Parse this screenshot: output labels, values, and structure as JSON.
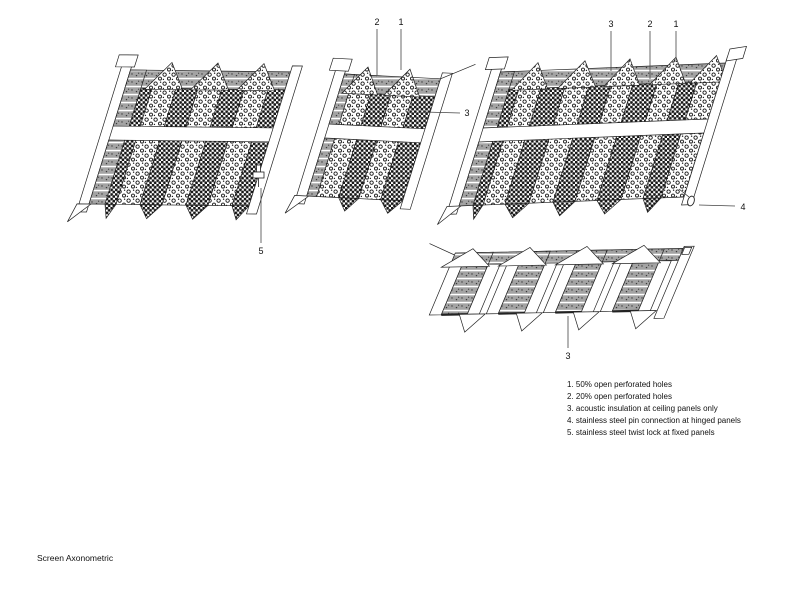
{
  "title": {
    "text": "Screen Axonometric"
  },
  "legend": {
    "items": [
      "1. 50% open perforated holes",
      "2. 20% open perforated holes",
      "3. acoustic insulation at ceiling panels only",
      "4. stainless steel pin connection at hinged panels",
      "5. stainless steel twist lock at fixed panels"
    ]
  },
  "colors": {
    "line": "#222222",
    "insulation_gray": "#a3a3a3",
    "background": "#ffffff"
  },
  "drawing": {
    "panels": [
      {
        "id": "left-screen",
        "o": [
          133,
          62
        ],
        "W": 160,
        "ty": 0.012,
        "lean": -0.31,
        "rows": 2,
        "rowH": 64,
        "pitch": 78,
        "tipH": 14,
        "bandTop": 8,
        "bandBot": 26,
        "peakBase": 27,
        "stripes": [
          [
            "insul",
            16
          ],
          [
            "dark",
            11
          ],
          [
            "pebble",
            24
          ],
          [
            "dark",
            22
          ],
          [
            "pebble",
            24
          ],
          [
            "dark",
            22
          ],
          [
            "pebble",
            24
          ],
          [
            "dark",
            17
          ]
        ],
        "features": [
          "leftRail",
          "topLeftBox",
          "bottomLeftFlag",
          "rightRail"
        ]
      },
      {
        "id": "middle-screen",
        "o": [
          347,
          66
        ],
        "W": 96,
        "ty": 0.05,
        "lean": -0.31,
        "rows": 2,
        "rowH": 58,
        "pitch": 72,
        "tipH": 13,
        "bandTop": 8,
        "bandBot": 26,
        "peakBase": 27,
        "stripes": [
          [
            "insul",
            10
          ],
          [
            "pebble",
            22
          ],
          [
            "dark",
            20
          ],
          [
            "pebble",
            22
          ],
          [
            "dark",
            22
          ]
        ],
        "features": [
          "leftRail",
          "topLeftBox",
          "bottomLeftFlag",
          "rightRail",
          "topRightLine"
        ]
      },
      {
        "id": "right-screen",
        "o": [
          503,
          64
        ],
        "W": 225,
        "ty": -0.04,
        "lean": -0.31,
        "rows": 2,
        "rowH": 64,
        "pitch": 78,
        "tipH": 14,
        "bandTop": 8,
        "bandBot": 26,
        "peakBase": 27,
        "stripes": [
          [
            "insul",
            14
          ],
          [
            "dark",
            10
          ],
          [
            "pebble",
            22
          ],
          [
            "dark",
            24
          ],
          [
            "pebble",
            24
          ],
          [
            "dark",
            22
          ],
          [
            "pebble",
            22
          ],
          [
            "dark",
            24
          ],
          [
            "pebble",
            22
          ],
          [
            "dark",
            18
          ],
          [
            "pebble",
            23
          ]
        ],
        "features": [
          "leftRail",
          "topLeftBox",
          "bottomLeftFlag",
          "rightRail",
          "topRightBox"
        ]
      },
      {
        "id": "ceiling-screen",
        "o": [
          457,
          249
        ],
        "W": 228,
        "ty": -0.02,
        "lean": -0.42,
        "rows": 1,
        "rowH": 66,
        "pitch": 80,
        "tipH": 18,
        "bandTop": 4,
        "bandBot": 16,
        "peakBase": 18,
        "stripes": [
          [
            "plain",
            12
          ],
          [
            "insul",
            26
          ],
          [
            "plain",
            12
          ],
          [
            "spacer",
            7
          ],
          [
            "plain",
            12
          ],
          [
            "insul",
            26
          ],
          [
            "plain",
            12
          ],
          [
            "spacer",
            7
          ],
          [
            "plain",
            12
          ],
          [
            "insul",
            26
          ],
          [
            "plain",
            12
          ],
          [
            "spacer",
            7
          ],
          [
            "plain",
            12
          ],
          [
            "insul",
            26
          ],
          [
            "plain",
            12
          ],
          [
            "spacer",
            7
          ]
        ],
        "peaks": [
          16,
          73,
          130,
          187
        ],
        "peakHW": 24,
        "peakFill": "#ffffff",
        "tips": [
          [
            30,
            56
          ],
          [
            87,
            113
          ],
          [
            144,
            170
          ],
          [
            201,
            227
          ]
        ],
        "tipFill": "#ffffff",
        "thickBottom": true,
        "features": [
          "rightRail",
          "topRightBoxSmall",
          "leftTailLine"
        ]
      }
    ],
    "callouts": [
      {
        "label": "2",
        "x": 377,
        "y": 22,
        "line": [
          377,
          29,
          377,
          75
        ]
      },
      {
        "label": "1",
        "x": 401,
        "y": 22,
        "line": [
          401,
          29,
          401,
          70
        ]
      },
      {
        "label": "3",
        "x": 467,
        "y": 113,
        "line": [
          460,
          113,
          424,
          112
        ]
      },
      {
        "label": "3",
        "x": 611,
        "y": 24,
        "line": [
          611,
          31,
          611,
          71
        ]
      },
      {
        "label": "2",
        "x": 650,
        "y": 24,
        "line": [
          650,
          31,
          650,
          79
        ]
      },
      {
        "label": "1",
        "x": 676,
        "y": 24,
        "line": [
          676,
          31,
          676,
          62
        ]
      },
      {
        "label": "4",
        "x": 743,
        "y": 207,
        "line": [
          735,
          206,
          699,
          205
        ]
      },
      {
        "label": "5",
        "x": 261,
        "y": 251,
        "line": [
          261,
          243,
          261,
          188
        ]
      },
      {
        "label": "3",
        "x": 568,
        "y": 356,
        "line": [
          568,
          348,
          568,
          316
        ]
      }
    ],
    "hardware": [
      {
        "type": "twist-lock",
        "x": 252,
        "y": 165
      },
      {
        "type": "pin",
        "x": 691,
        "y": 201
      }
    ]
  }
}
